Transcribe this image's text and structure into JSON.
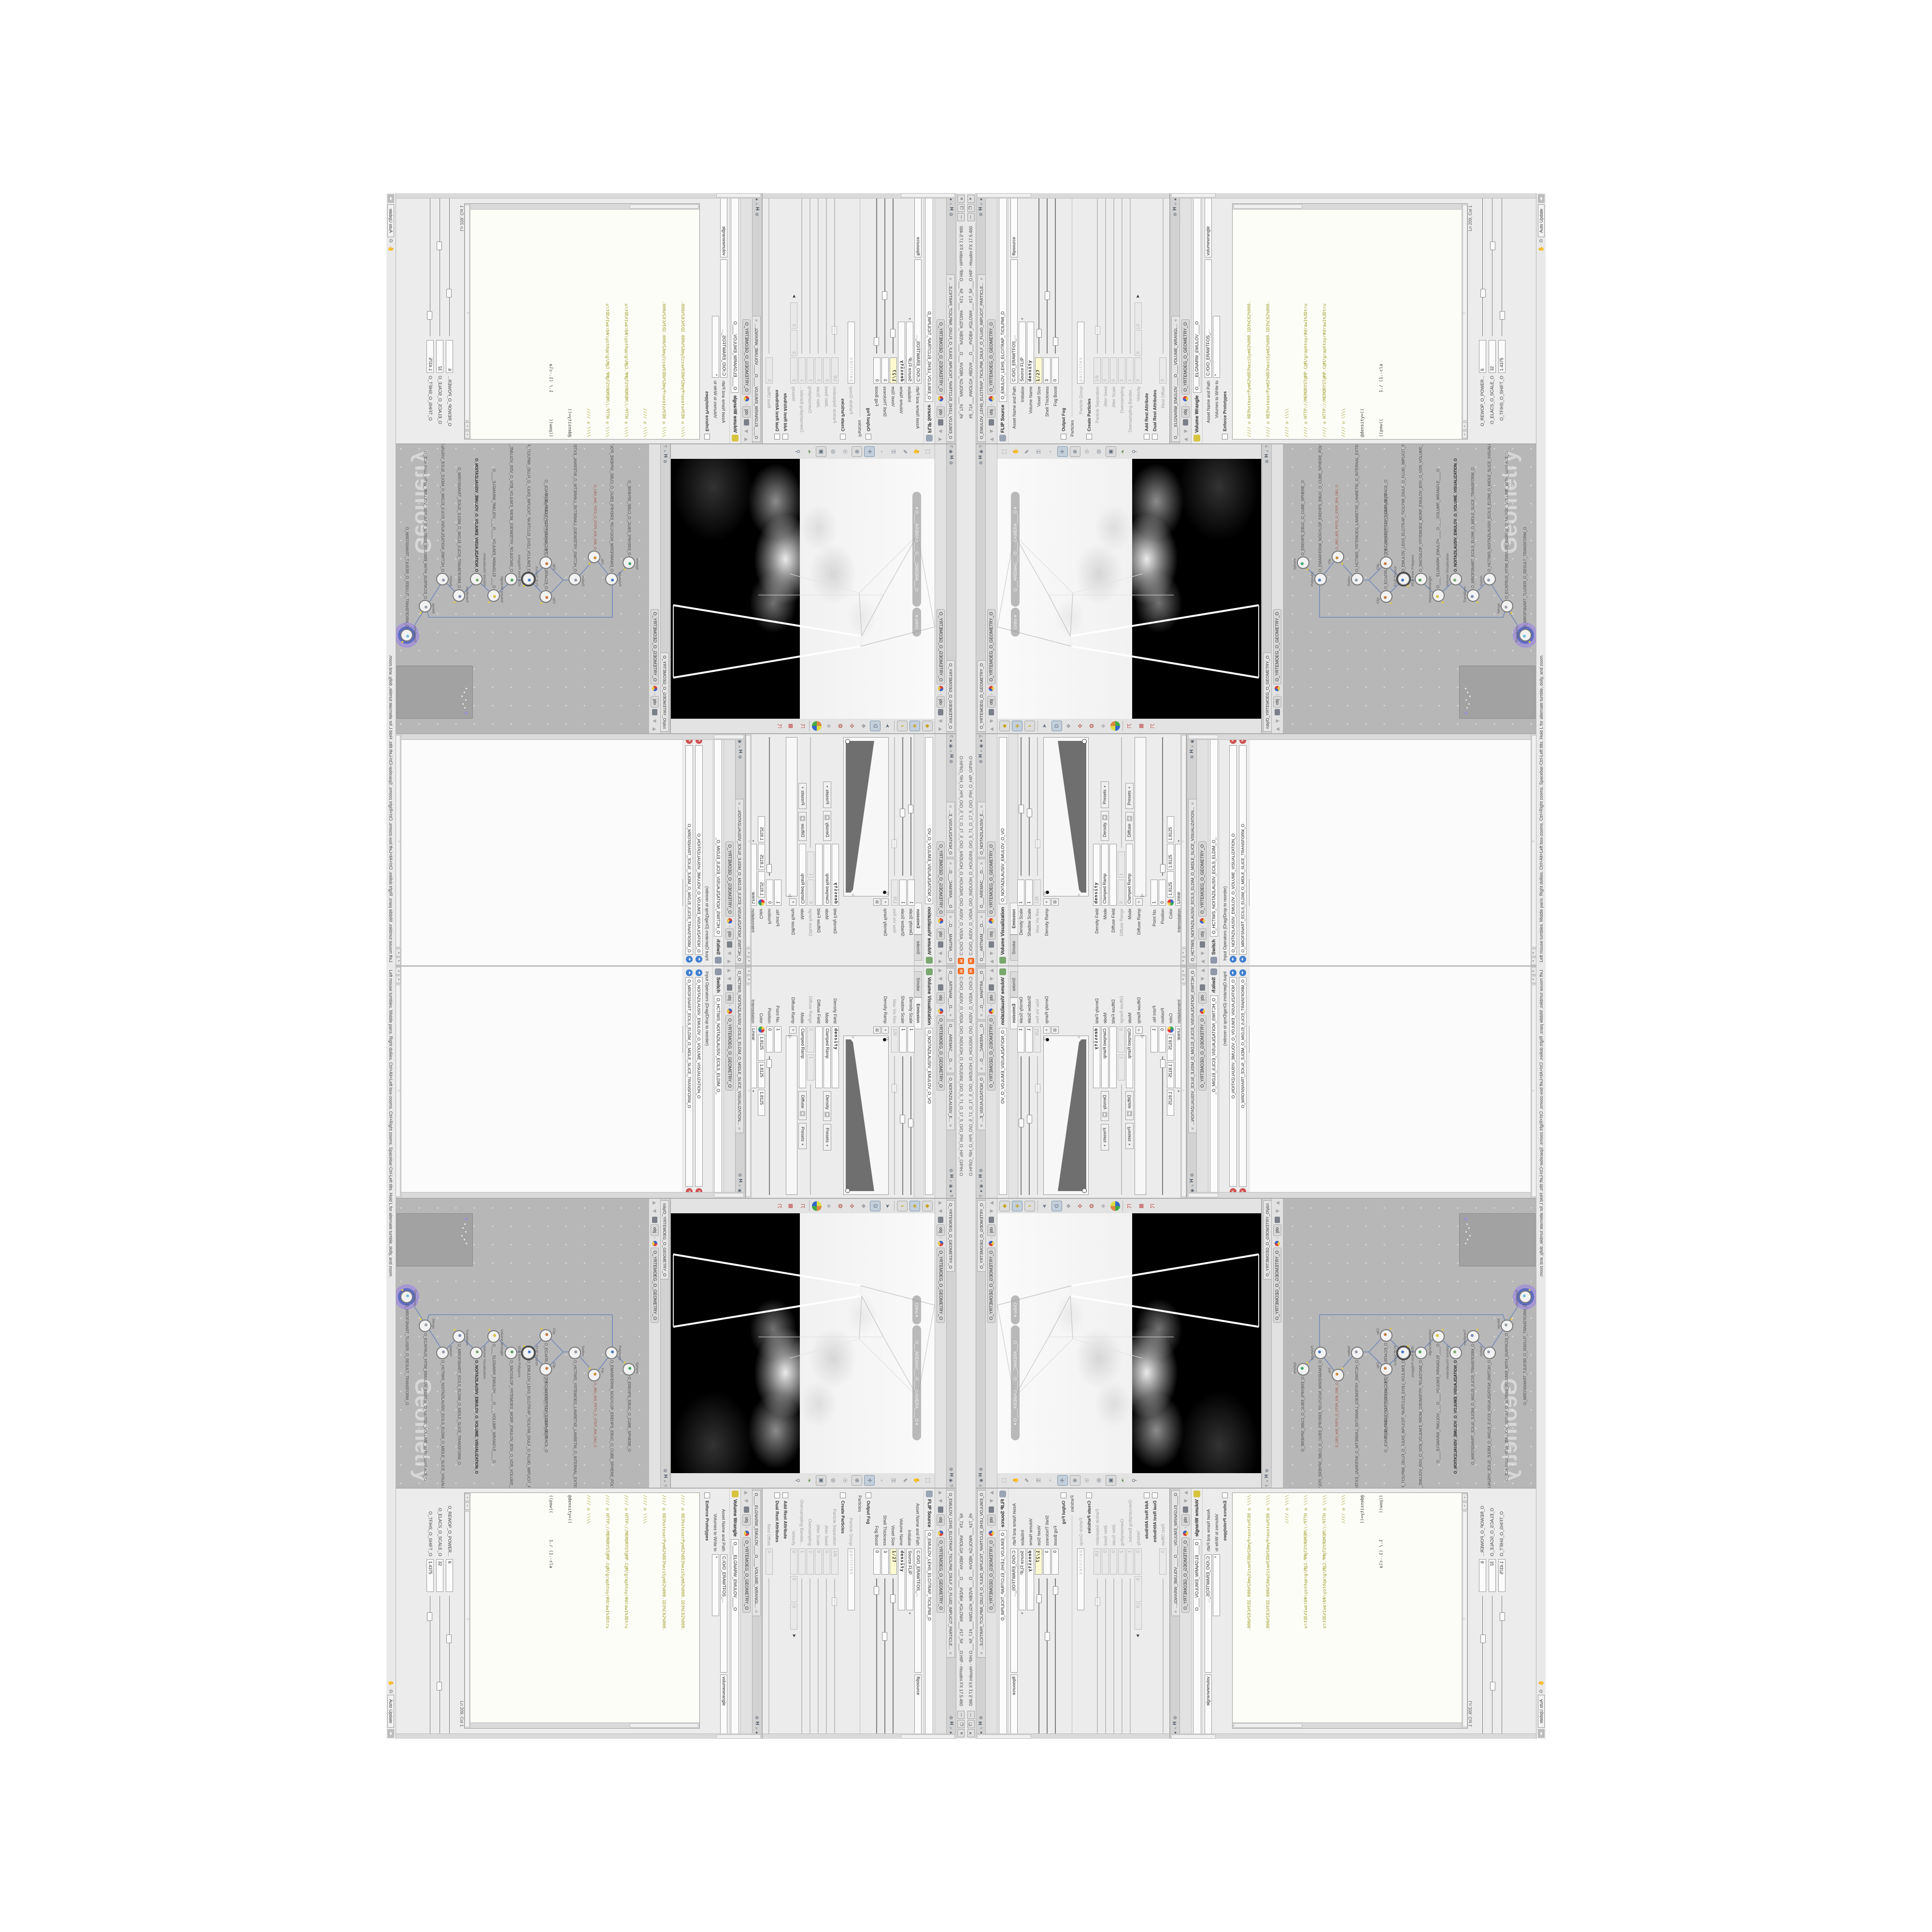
{
  "colors": {
    "accent_orange": "#f26b22",
    "code_olive": "#9a9a22",
    "field_yellow": "#fdfad0",
    "wire_blue": "#7288b8",
    "selection_purple": "#a08cd8",
    "network_bg": "#b7b7b7"
  },
  "title_bar": {
    "logo": "H",
    "path_text": "C:/O/O_AIDIV_O_VIDIA_O/O_INIDUOH_O_HOUDINI_O/O_5_71_O_17_5_O/O_PIH_O_HIP_O/PIH.O",
    "title_text": "#5_71#___#WOLG#_#BDV#___O___#VDB#_#GLOW#___#17_5#___O.HIP - Houdini FX 17.5.460",
    "buttons": {
      "minimize": "—",
      "maximize": "❐",
      "close": "✕"
    }
  },
  "path_bar": {
    "up": "▲",
    "down": "▼",
    "context": "obj",
    "node": "O_YRTEMOEG_O_GEOMETRY_O",
    "pane_icons": [
      "⚙",
      "H",
      "⌕",
      "◉",
      "●",
      "?"
    ]
  },
  "viz_pane": {
    "tabs": [
      "O___ARTNAM___O...",
      "O___AREMAC___O...",
      "O_NOITAZILAUSIV_E..."
    ],
    "tab_close": "✕",
    "node_type": "Volume Visualization",
    "node_name": "O_NOITAZILAUSIV_EMULOV_O_VO",
    "folder_tabs": [
      "Smoke",
      "Emission"
    ],
    "params": [
      {
        "label": "Density Scale",
        "value": "1"
      },
      {
        "label": "Shadow Scale",
        "value": "1"
      },
      {
        "label": "Max Vis Res",
        "value": "128"
      },
      {
        "label": "Density Ramp"
      },
      {
        "label": "Density Field",
        "value": "density"
      },
      {
        "label": "Mode",
        "value": "Clamped Ramp",
        "btn1": "Density",
        "btn2": "Presets"
      },
      {
        "label": "Diffuse Field",
        "value": ""
      },
      {
        "label": "Diffuse Range",
        "value": "0",
        "value2": "1"
      },
      {
        "label": "Mode",
        "value": "Clamped Ramp",
        "btn1": "Diffuse",
        "btn2": "Presets"
      },
      {
        "label": "Diffuse Ramp"
      },
      {
        "label": "Point No.",
        "value": "1"
      },
      {
        "label": "Position",
        "value": "0"
      },
      {
        "label": "Color",
        "value": "1.8125",
        "value2": "1.8125",
        "value3": "1.8125"
      },
      {
        "label": "Interpolation",
        "value": "Linear"
      }
    ]
  },
  "switch_pane": {
    "tab": "O_HCTIWS_NOITAZILAUSIV_ECILS_ELDIM_O_MIDLE_SLICE_VISUALIZATION...",
    "tab_close": "✕",
    "node_type": "Switch",
    "node_name": "O_HCTIWS_NOITAZILAUSIV_ECILS_ELDIM_O_",
    "inputs_label": "Input Operators (Drag/Drop to reorder)",
    "inputs": [
      "O_NOITAZILAUSIV_EMULOV_O_VOLUME_VISUALIZATION_O",
      "O_MROFSNART_ECILS_ELDIM_O_MIDLE_SLICE_TRANSFORM_O"
    ],
    "select_label": "Select Input",
    "select_value": "0"
  },
  "viewport_pane": {
    "tab": "O_YRTEMOEG_O_GEOMETRY_O",
    "pills": [
      "Ortho ▾",
      "O___AREMAC___O____CAMERA____O ▾"
    ]
  },
  "network_pane": {
    "tab": "/obj/O_YRTEMOEG_O_GEOMETRY_O",
    "watermark": "Geometry",
    "nodes": [
      {
        "type": "Sphere",
        "name": "O_EREHPS_EBUC_O_CUBE_SPHERE_O"
      },
      {
        "type": "PolyWire",
        "name": "O_EMARFERIW_NOGYLOP_EREHPS_EBUC_O_CUBE_SPHERE_POLYGON_WIREFRAME_O"
      },
      {
        "type": "File",
        "name": "O_JBO_403_PETS_O_STEP_304_OBJ_O"
      },
      {
        "type": "Switch",
        "name": "O_HCTIWS_YRTEMOEG_LANRETXE_LANRETNI_O_INTERNAL_EXTERNAL_GEOMETRY_SWITCH_O"
      },
      {
        "type": "Clip",
        "name": "O_ECAFRUS_POT_PILC_O_CLIP_TOP_SURFACE_O"
      },
      {
        "type": "Clip",
        "name": "O_ECAFRUS_PILC_O_CLIP_SURFACE_O"
      },
      {
        "type": "FLIP Source",
        "name": "O_EMULOV_LEHS_ELCITRAP_TICILPMI_DIULF_O_FLUID_IMPLICIT_PARTICLE_SHEL_VOLUME_O"
      },
      {
        "type": "VDB from Polygons",
        "name": "O_SNOGILOP_YRTEMOEG_MORF_EMULOV_BDV_O_VDB_VOLUME_FROM_GEOMETRY_POLYGONS_O"
      },
      {
        "type": "Volume Wrangle",
        "name": "O____ELGNARW_EMULOV____O____VOLUME_WRANGLE____O"
      },
      {
        "type": "Volume Visualization",
        "name": "O_NOITAZILAUSIV_EMULOV_O_VOLUME_VISUALIZATION_O"
      },
      {
        "type": "Transform",
        "name": "O_MROFSNART_ECILS_ELDIM_O_MIDLE_SLICE_TRANSFORM_O"
      },
      {
        "type": "Switch",
        "name": "O_HCTIWS_NOITAZILAUSIV_ECILS_ELDIM_O_MIDLE_SLICE_VISUALIZATION_SWITCH_O"
      },
      {
        "type": "Merge",
        "name": "O_ECAFRUS_HTIW_EMULOV_EGREM_O_MERGE_VOLUME_WITH_SURFACE_O"
      },
      {
        "type": "Transform",
        "name": "O_MROFSNART_TLUSER_O_RESULT_TRANSFORM_O"
      }
    ]
  },
  "flip_pane": {
    "tab": "O_EMULOV_LEHS_ELCITRAP_TICILPMI_DIULF_O_FLUID_IMPLICIT_PARTICLE...",
    "tab_close": "✕",
    "node_type": "FLIP Source",
    "node_name": "O_EMULOV_LEHS_ELCITRAP_TICILPMI_D",
    "params": [
      {
        "label": "Asset Name and Path",
        "value": "C:/O/O_ERAWTFOS_...",
        "value2": "flipsource"
      },
      {
        "label": "Initialize",
        "value": "Source FLIP"
      },
      {
        "label": "Volume Name",
        "value": "density"
      },
      {
        "label": "Voxel Size",
        "value": "1/27"
      },
      {
        "label": "Shell Thickness",
        "value": "3"
      },
      {
        "label": "Fog Boost",
        "value": "0"
      },
      {
        "label": "Output Fog"
      },
      {
        "label": "Particles"
      },
      {
        "label": "Particle Group",
        "value": "particles"
      },
      {
        "label": "Create Particles"
      },
      {
        "label": "Particle Separation",
        "value": "1/9"
      },
      {
        "label": "Jitter Seed",
        "value": "0"
      },
      {
        "label": "Jitter Scale",
        "value": "0"
      },
      {
        "label": "Oversampling",
        "value": "2"
      },
      {
        "label": "Oversampling Bandwi...",
        "value": "1"
      },
      {
        "label": "Velocity",
        "value": "0",
        "value2": "0",
        "value3": "0"
      },
      {
        "label": "Add Rest Attribute"
      },
      {
        "label": "Dual Rest Attributes"
      },
      {
        "label": "Rest Offset",
        "value": "0"
      }
    ]
  },
  "wrangle_pane": {
    "tab": "O____ELGNARW_EMULOV____O____VOLUME_WRANGL...",
    "tab_close": "✕",
    "node_type": "Volume Wrangle",
    "node_name": "O____ELGNARW_EMULOV____O",
    "asset_label": "Asset Name and Path",
    "asset_path": "C:/O/O_ERAWTFOS_...",
    "asset_name": "volumewrangle",
    "volumes_label": "Volumes to Write to",
    "volumes_value": "*",
    "enforce_label": "Enforce Prototypes",
    "code_lines": [
      "//// ◎ 0D3%steserPym62%0D3%eziSym62%000.1D3%C62%000.",
      "//// ◎ 0D3%steserPym62%0D3%eziSym62%000.1D3%C62%000.",
      "//// ◎ \\\\\\\\",
      "//// ◎ HTTP://MEMORYST@MP.C@M/graphtoy/#draw1%3Dtru",
      "//// ◎ HTTP://MEMORYST@MP.C@M/graphtoy/#draw1%3Dtru",
      "//// ◎ \\\\\\\\",
      "@density=((",
      "((pow((          1./ (1.-cla"
    ],
    "status": "Ln 209, Col 1",
    "sliders": [
      {
        "label": "O_REWOP_O_POWER...",
        "value": "6"
      },
      {
        "label": "O_ELACS_O_SCALE_O",
        "value": "32"
      },
      {
        "label": "O_TFIHS_O_SHIFT_O",
        "value": "1.4375"
      }
    ]
  },
  "help_bar": {
    "text": "Left mouse tumbles.  Middle pans.  Right dollies.  Ctrl+Alt+Left box-zooms.  Ctrl+Right zooms.  Spacebar-Ctrl-Left tilts.  Hold L for alternate tumble, dolly, and zoom.",
    "update_mode": "Auto Update"
  }
}
